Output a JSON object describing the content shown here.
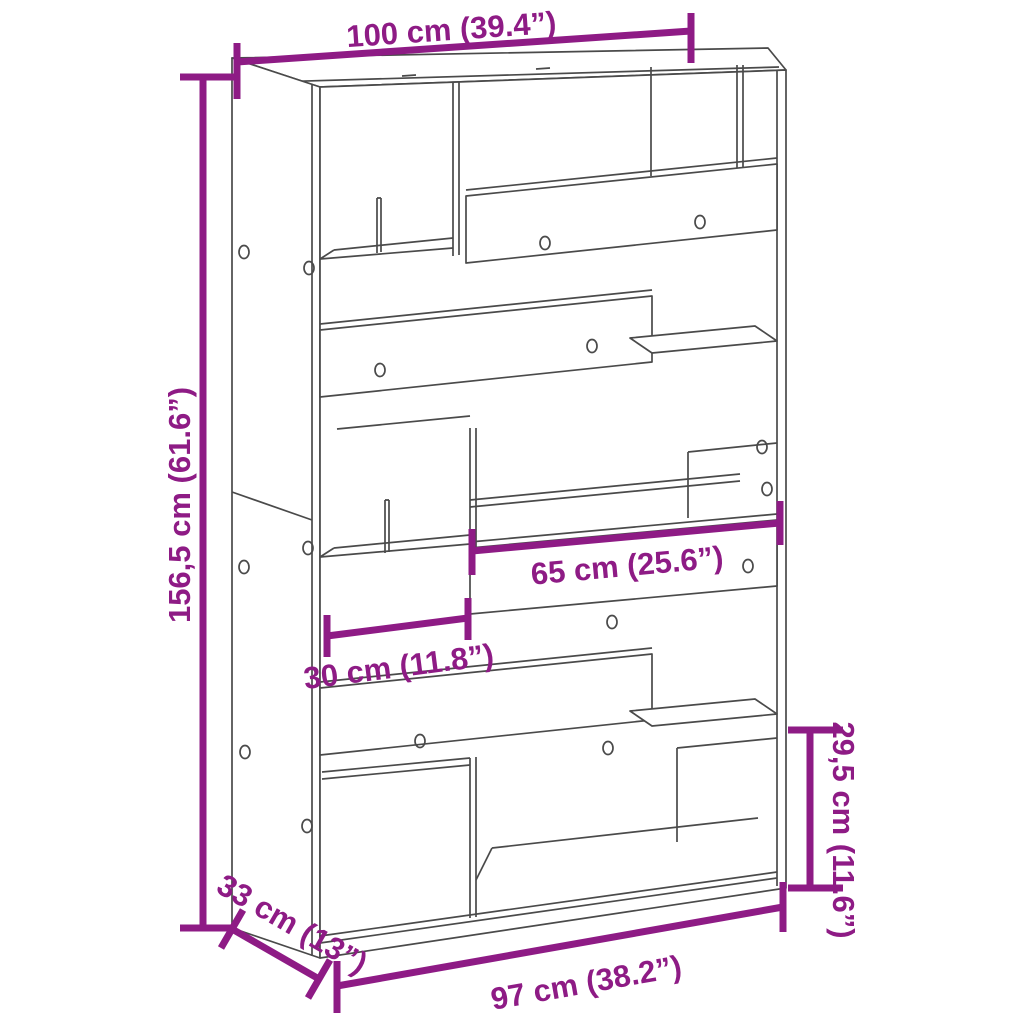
{
  "diagram": {
    "type": "furniture-dimension-diagram",
    "subject": "room-divider bookcase line drawing, 3D perspective",
    "colors": {
      "dimension_accent": "#8E1B85",
      "drawing_line": "#4a4a4a",
      "background": "#ffffff"
    },
    "dimensions": {
      "width_top": "100 cm (39.4”)",
      "height": "156,5 cm (61.6”)",
      "shelf_width": "65 cm (25.6”)",
      "compartment_width": "30 cm (11.8”)",
      "compartment_height": "29,5 cm (11.6”)",
      "depth": "33 cm (13”)",
      "width_bottom": "97 cm (38.2”)"
    }
  }
}
